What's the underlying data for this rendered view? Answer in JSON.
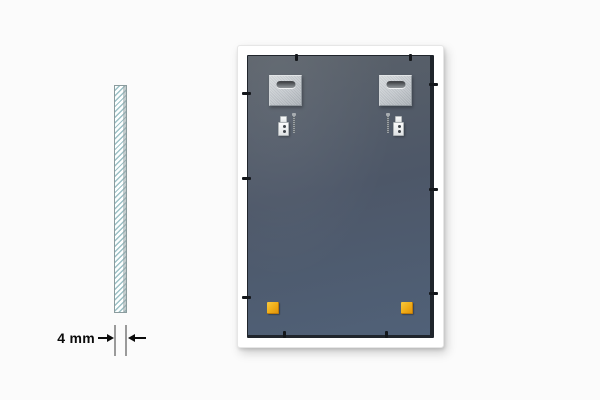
{
  "scene": {
    "type": "product-illustration",
    "alt": "Back view of a rectangular mirror with hanging hardware, next to a cross-section strip showing 4 mm glass thickness"
  },
  "dimension": {
    "label": "4 mm",
    "value": 4,
    "unit": "mm"
  },
  "glass_strip": {
    "pattern": "diagonal-hatch",
    "represents": "glass thickness cross-section"
  },
  "mirror": {
    "parts": {
      "hanger_plates": [
        "left",
        "right"
      ],
      "hooks": [
        "left",
        "right"
      ],
      "screws": [
        "left",
        "right"
      ],
      "corner_pads": [
        "bottom-left",
        "bottom-right"
      ],
      "retainer_clip_count": 10
    }
  },
  "colors": {
    "bg": "#fbfbfb",
    "ink": "#0b0b0b",
    "ext-line": "#9a9a9a",
    "hatch": "#9cc0c5",
    "strip-fill": "#fcffff",
    "strip-edge": "#8b9c9e",
    "frame": "#ffffff",
    "rebate": "#20252c",
    "panel-top": "#5a6169",
    "panel-mid": "#4d5768",
    "panel-bottom": "#506178",
    "plate-light": "#d7dbde",
    "plate-dark": "#aab0b6",
    "pad": "#f0ad17",
    "pad-dark": "#c07c08",
    "clip": "#14171b"
  }
}
